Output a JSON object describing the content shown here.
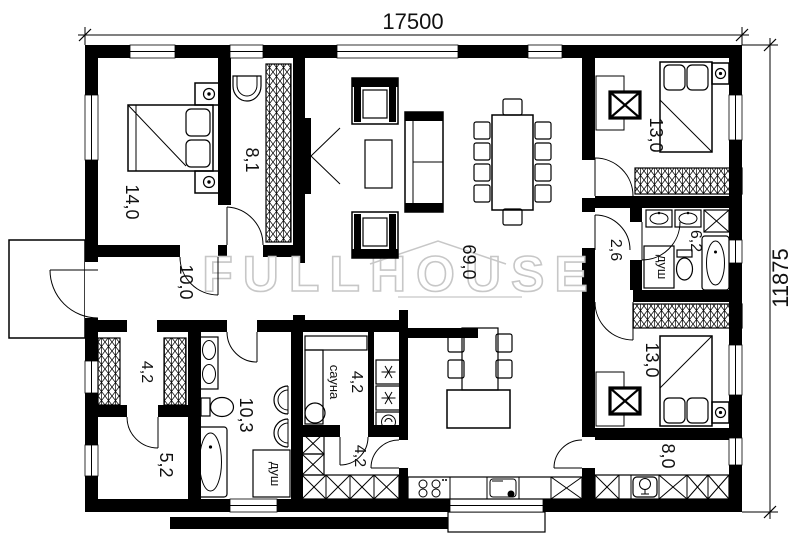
{
  "drawing": {
    "type": "floor-plan",
    "wall_color": "#000000",
    "watermark_color": "#c7c7c7"
  },
  "dims": {
    "top": "17500",
    "right": "11875"
  },
  "watermark": {
    "text": "FULLHOUSE"
  },
  "rooms": {
    "bedroom_left": {
      "area": "14,0"
    },
    "closet": {
      "area": "8,1"
    },
    "hallway": {
      "area": "10,0"
    },
    "living": {
      "area": "69,0"
    },
    "bedroom_top_right": {
      "area": "13,0"
    },
    "corridor": {
      "area": "2,6"
    },
    "bathroom_small": {
      "area": "6,2",
      "shower_label": "душ"
    },
    "bedroom_bottom_right": {
      "area": "13,0"
    },
    "hall_bottom": {
      "area": "8,0"
    },
    "wardrobe": {
      "area": "4,2"
    },
    "storage": {
      "area": "5,2"
    },
    "bathroom_main": {
      "area": "10,3",
      "shower_label": "душ"
    },
    "sauna": {
      "area": "4,2",
      "name": "сауна"
    },
    "pantry": {
      "area": "4,2"
    }
  }
}
